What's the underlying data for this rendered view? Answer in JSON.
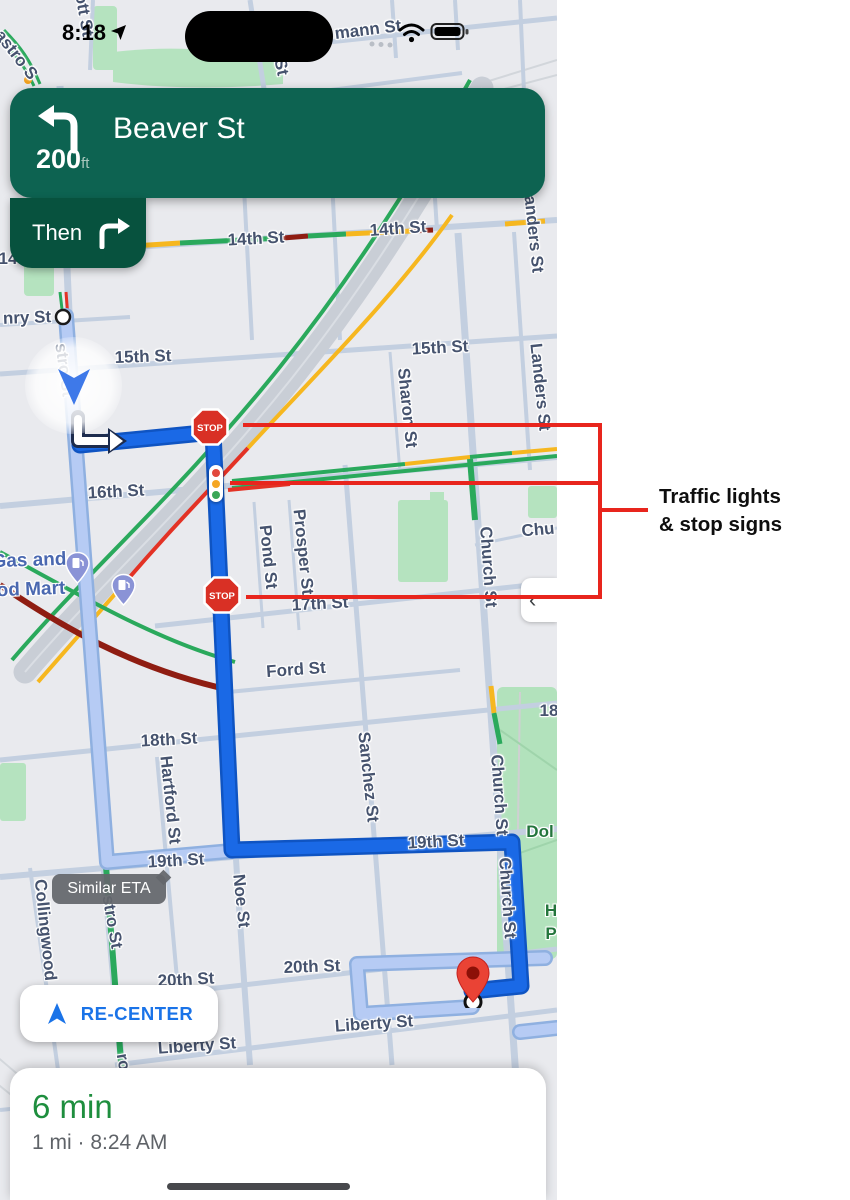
{
  "status_bar": {
    "time": "8:18"
  },
  "nav_banner": {
    "instruction": "Beaver St",
    "distance": "200",
    "distance_unit": "ft",
    "then_label": "Then"
  },
  "annotation": {
    "line1": "Traffic lights",
    "line2": "& stop signs",
    "color": "#e8251d"
  },
  "map": {
    "street_labels": [
      {
        "text": "ott St"
      },
      {
        "text": "astro S"
      },
      {
        "text": "St"
      },
      {
        "text": "mann St"
      },
      {
        "text": "14th St"
      },
      {
        "text": "14th St"
      },
      {
        "text": "14"
      },
      {
        "text": "Landers St"
      },
      {
        "text": "Landers St"
      },
      {
        "text": "15th St"
      },
      {
        "text": "15th St"
      },
      {
        "text": "Sharon St"
      },
      {
        "text": "nry St"
      },
      {
        "text": "stro St"
      },
      {
        "text": "16th St"
      },
      {
        "text": "Pond St"
      },
      {
        "text": "Prosper St"
      },
      {
        "text": "Church St"
      },
      {
        "text": "Chu"
      },
      {
        "text": "17th St"
      },
      {
        "text": "Ford St"
      },
      {
        "text": "18th St"
      },
      {
        "text": "18"
      },
      {
        "text": "Hartford St"
      },
      {
        "text": "Sanchez St"
      },
      {
        "text": "19th St"
      },
      {
        "text": "19th St"
      },
      {
        "text": "Collingwood"
      },
      {
        "text": "stro St"
      },
      {
        "text": "Noe St"
      },
      {
        "text": "20th St"
      },
      {
        "text": "20th St"
      },
      {
        "text": "Liberty St"
      },
      {
        "text": "Liberty St"
      },
      {
        "text": "Church St"
      },
      {
        "text": "Church St"
      },
      {
        "text": "ro"
      }
    ],
    "poi_labels": [
      {
        "text": "Gas and"
      },
      {
        "text": "od Mart"
      },
      {
        "text": "Dol"
      },
      {
        "text": "H"
      },
      {
        "text": "P"
      }
    ],
    "stop_sign_text": "STOP",
    "similar_eta_label": "Similar ETA",
    "recenter_label": "RE-CENTER",
    "side_tab_chevron": "‹"
  },
  "bottom_sheet": {
    "eta": "6 min",
    "details": "1 mi · 8:24 AM"
  },
  "colors": {
    "banner_green": "#0d6351",
    "then_green": "#07523e",
    "route_blue": "#1a69e6",
    "alt_route_blue": "#b6cbf4",
    "traffic_green": "#2aa95c",
    "traffic_yellow": "#f6b71f",
    "traffic_red": "#e33225",
    "traffic_dark_red": "#8f1d12",
    "eta_green": "#1e8e3e",
    "recenter_blue": "#1a73e8",
    "annotation_red": "#e8251d"
  }
}
